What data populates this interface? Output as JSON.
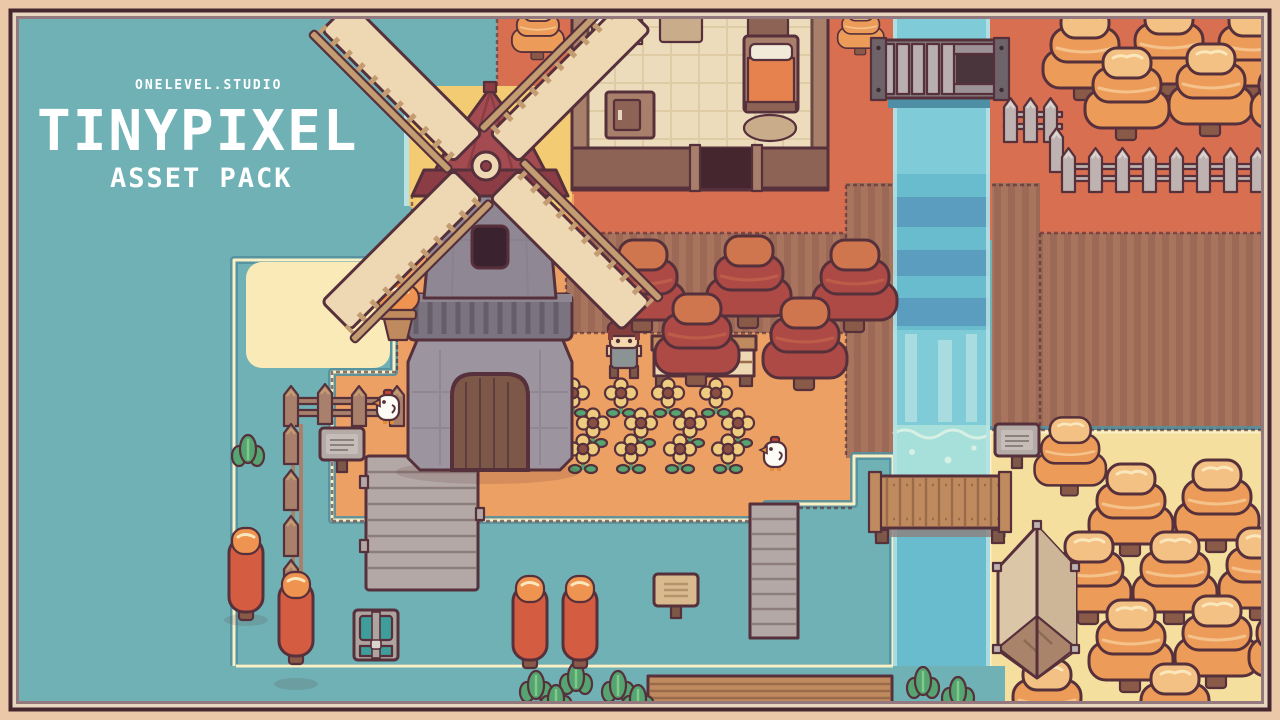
{
  "branding": {
    "studio": "ONELEVEL.STUDIO",
    "title": "TINYPIXEL",
    "pack": "ASSET PACK"
  },
  "palette": {
    "water": "#6FB1B5",
    "water_edge_dark": "#54919F",
    "grass_red": "#D96F51",
    "grass_orange": "#ECA064",
    "sand": "#F4DF9E",
    "sand_light": "#F9EAB8",
    "sand_edge": "#FAF0C6",
    "gold": "#F2CB72",
    "dirt": "#A8745D",
    "dirt_dark": "#9B6955",
    "river": "#69BCCE",
    "river_light": "#7FCBD8",
    "river_dark": "#5B9DBE",
    "foam": "#A7E0DB",
    "river_edge": "#B9E2E4",
    "outline": "#56303B",
    "frame_outer": "#EAC8A8",
    "frame_dark": "#46262F",
    "frame_cream": "#E8D6C0",
    "frame_mauve": "#93787E",
    "stone": "#8F8894",
    "stone_light": "#9C95A0",
    "stone_dark": "#7B7380",
    "cap_red": "#A34B50",
    "cap_red_dark": "#8B3C45",
    "blade_cream": "#EED8B4",
    "blade_wood": "#C49C72",
    "wood": "#A9806B",
    "wood_dark": "#7D5848",
    "plank_gray": "#B3A8A6",
    "plank_gray_dark": "#8D7E7C",
    "bridge_wood": "#C08A5F",
    "bridge_wood_dark": "#9A6B4A",
    "fence_gray": "#BEB3B0",
    "tree_orange": "#EC9C58",
    "tree_orange_light": "#F4C184",
    "tree_cream": "#FBE7BC",
    "tree_red": "#AE4A46",
    "tree_red_light": "#D0764E",
    "cypress": "#D45C41",
    "cypress_light": "#EF9350",
    "trunk": "#8A5A49",
    "leaf": "#55A471",
    "flower": "#EECB7E",
    "flower_center": "#8A4F42",
    "floor": "#ECDCBB",
    "floor_line": "#DFCBA4",
    "wall": "#8D6355",
    "wall_light": "#A87F6B",
    "door_dark": "#45262F",
    "bed_orange": "#E5824D",
    "pillow": "#F2EAD8",
    "rug": "#C9AD8A",
    "chicken_white": "#FCFCF4",
    "comb_red": "#CC4434",
    "beak_orange": "#E08B3A",
    "char_hair": "#843E3B",
    "char_skin": "#F3D9AD",
    "char_shirt": "#8B9394",
    "chest_teal": "#3F9D9B",
    "chest_gray": "#ADA39F",
    "sign_gray": "#B4ABA7",
    "sign_tan": "#D9BA8E",
    "tent": "#DCC6A8",
    "tent_shade": "#CDB697",
    "tent_dark": "#A9846B",
    "title_white": "#FFFFFF"
  }
}
